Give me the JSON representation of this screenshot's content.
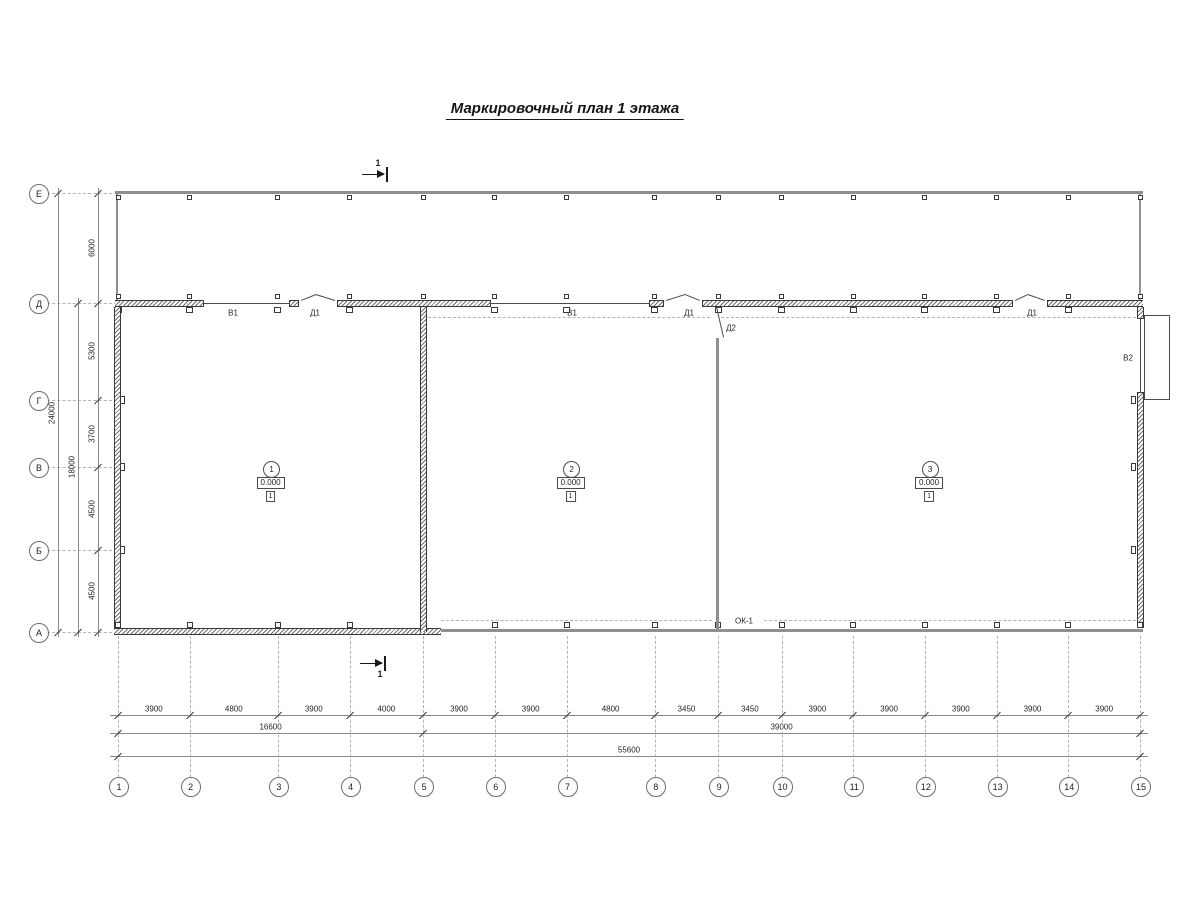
{
  "title": "Маркировочный план 1 этажа",
  "section_marker": {
    "label": "1"
  },
  "axes": {
    "columns": [
      "1",
      "2",
      "3",
      "4",
      "5",
      "6",
      "7",
      "8",
      "9",
      "10",
      "11",
      "12",
      "13",
      "14",
      "15"
    ],
    "rows": [
      "Е",
      "Д",
      "Г",
      "В",
      "Б",
      "А"
    ]
  },
  "dimensions": {
    "column_segments": [
      "3900",
      "4800",
      "3900",
      "4000",
      "3900",
      "3900",
      "4800",
      "3450",
      "3450",
      "3900",
      "3900",
      "3900",
      "3900",
      "3900"
    ],
    "column_groups": [
      {
        "value": "16600",
        "from": 1,
        "to": 5
      },
      {
        "value": "39000",
        "from": 5,
        "to": 15
      }
    ],
    "column_total": {
      "value": "55600",
      "from": 1,
      "to": 15
    },
    "row_segments": [
      "6000",
      "5300",
      "3700",
      "4500",
      "4500"
    ],
    "row_groups": [
      {
        "value": "18000",
        "from": 2,
        "to": 6
      }
    ],
    "row_total": {
      "value": "24000",
      "from": 1,
      "to": 6
    }
  },
  "rooms": [
    {
      "number": "1",
      "elevation": "0.000",
      "floor_type": "1"
    },
    {
      "number": "2",
      "elevation": "0.000",
      "floor_type": "1"
    },
    {
      "number": "3",
      "elevation": "0.000",
      "floor_type": "1"
    }
  ],
  "top_wall_openings": [
    {
      "label": "В1",
      "kind": "window",
      "x1": 203,
      "x2": 290,
      "label_x": 233
    },
    {
      "label": "Д1",
      "kind": "door",
      "x1": 298,
      "x2": 338,
      "peak": 316,
      "label_x": 315
    },
    {
      "label": "В1",
      "kind": "window",
      "x1": 490,
      "x2": 650,
      "label_x": 572
    },
    {
      "label": "Д1",
      "kind": "door",
      "x1": 663,
      "x2": 703,
      "peak": 685,
      "label_x": 689
    },
    {
      "label": "Д1",
      "kind": "door",
      "x1": 1012,
      "x2": 1048,
      "peak": 1028,
      "label_x": 1032
    }
  ],
  "right_wall_opening": {
    "label": "В2",
    "y1": 318,
    "y2": 393,
    "label_y": 358
  },
  "interior_door": {
    "label": "Д2"
  },
  "ribbon_window_label": "ОК-1",
  "colors": {
    "line": "#4a4a4a",
    "thick_wall": "#8f8f8f",
    "dim_line": "#8a8a8a",
    "tick": "#3a3a3a",
    "dash": "#b3b3b3",
    "text": "#262626"
  }
}
